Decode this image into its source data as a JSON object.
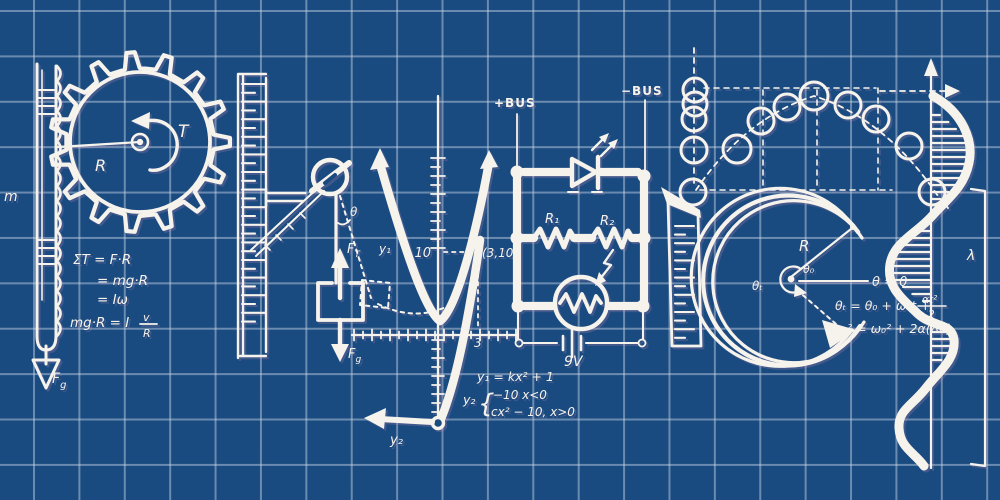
{
  "colors": {
    "background": "#1a4b80",
    "grid": "#cdd8e9",
    "ink": "#f6f3ec"
  },
  "p": {
    "mass_label": "m",
    "radius_label": "R",
    "torque_label": "T",
    "rack_force_base": "F",
    "rack_force_sub": "g",
    "eq1": "ΣT = F·R",
    "eq2": "= mg·R",
    "eq3": "= Iω",
    "eq4_main": "mg·R = I",
    "eq4_num": "v",
    "eq4_den": "R"
  },
  "h": {
    "angle_label": "θ",
    "arc_label": "y₁",
    "tension_base": "F",
    "tension_sub": "T",
    "gravity_base": "F",
    "gravity_sub": "g"
  },
  "y": {
    "ytick_label": "10",
    "point_label": "(3,10)",
    "xtick_label": "3",
    "tail_label": "y₂",
    "eq1": "y₁ = kx² + 1",
    "eq2_lhs": "y₂",
    "brace": "{",
    "eq2_case1": "−10   x<0",
    "eq2_case2": "cx² − 10,  x>0"
  },
  "circuit": {
    "plus_bus": "+BUS",
    "minus_bus": "−BUS",
    "r1": "R₁",
    "r2": "R₂",
    "battery": "9V"
  },
  "c": {
    "radius_label": "R",
    "theta_t": "θₜ",
    "theta_0": "θ₀",
    "ref_eq": "θ = 0",
    "eq1_main": "θₜ = θ₀ + ω₀t +",
    "eq1_num": "αt²",
    "eq1_den": "2",
    "eq2": "ωₜ² = ω₀² + 2α(Δθ)"
  },
  "wave": {
    "lambda_label": "λ"
  }
}
